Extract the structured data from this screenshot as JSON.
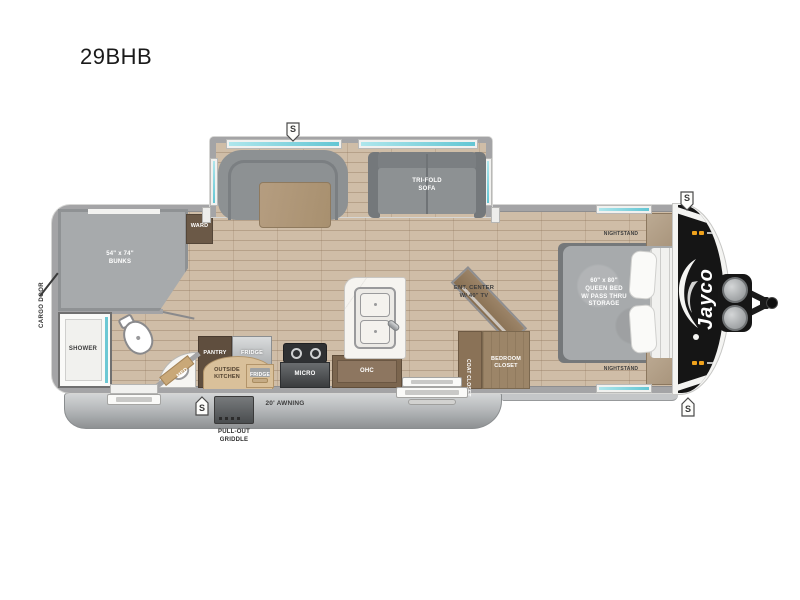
{
  "title": "29BHB",
  "brand_logo": "Jayco",
  "badge_letter": "S",
  "exterior": {
    "cargo_door": "CARGO DOOR",
    "awning": "20' AWNING",
    "griddle": "PULL-OUT\nGRIDDLE"
  },
  "labels": {
    "sofa": "TRI-FOLD\nSOFA",
    "bunks": "54\" x 74\"\nBUNKS",
    "ward": "WARD",
    "shower": "SHOWER",
    "med": "MED",
    "pantry": "PANTRY",
    "fridge": "FRIDGE",
    "outside_kitchen": "OUTSIDE\nKITCHEN",
    "outside_fridge": "FRIDGE",
    "micro": "MICRO",
    "ohc": "OHC",
    "ent_center": "ENT. CENTER\nW/ 40\" TV",
    "coat_closet": "COAT CLOSET",
    "bedroom_closet": "BEDROOM\nCLOSET",
    "nightstand_top": "NIGHTSTAND",
    "nightstand_bottom": "NIGHTSTAND",
    "queen_bed": "60\" x 80\"\nQUEEN BED\nW/ PASS THRU\nSTORAGE"
  },
  "colors": {
    "floor_wood": "#cfbda7",
    "wall_gray": "#a4a4a6",
    "cushion_gray": "#8d9193",
    "cabinet_brown": "#7b654e",
    "counter_white": "#f6f4f0",
    "window_teal": "#6cc8d4",
    "front_cap_black": "#151515",
    "marker_amber": "#f0a21c",
    "awning_gray": "#b0b3b5"
  }
}
